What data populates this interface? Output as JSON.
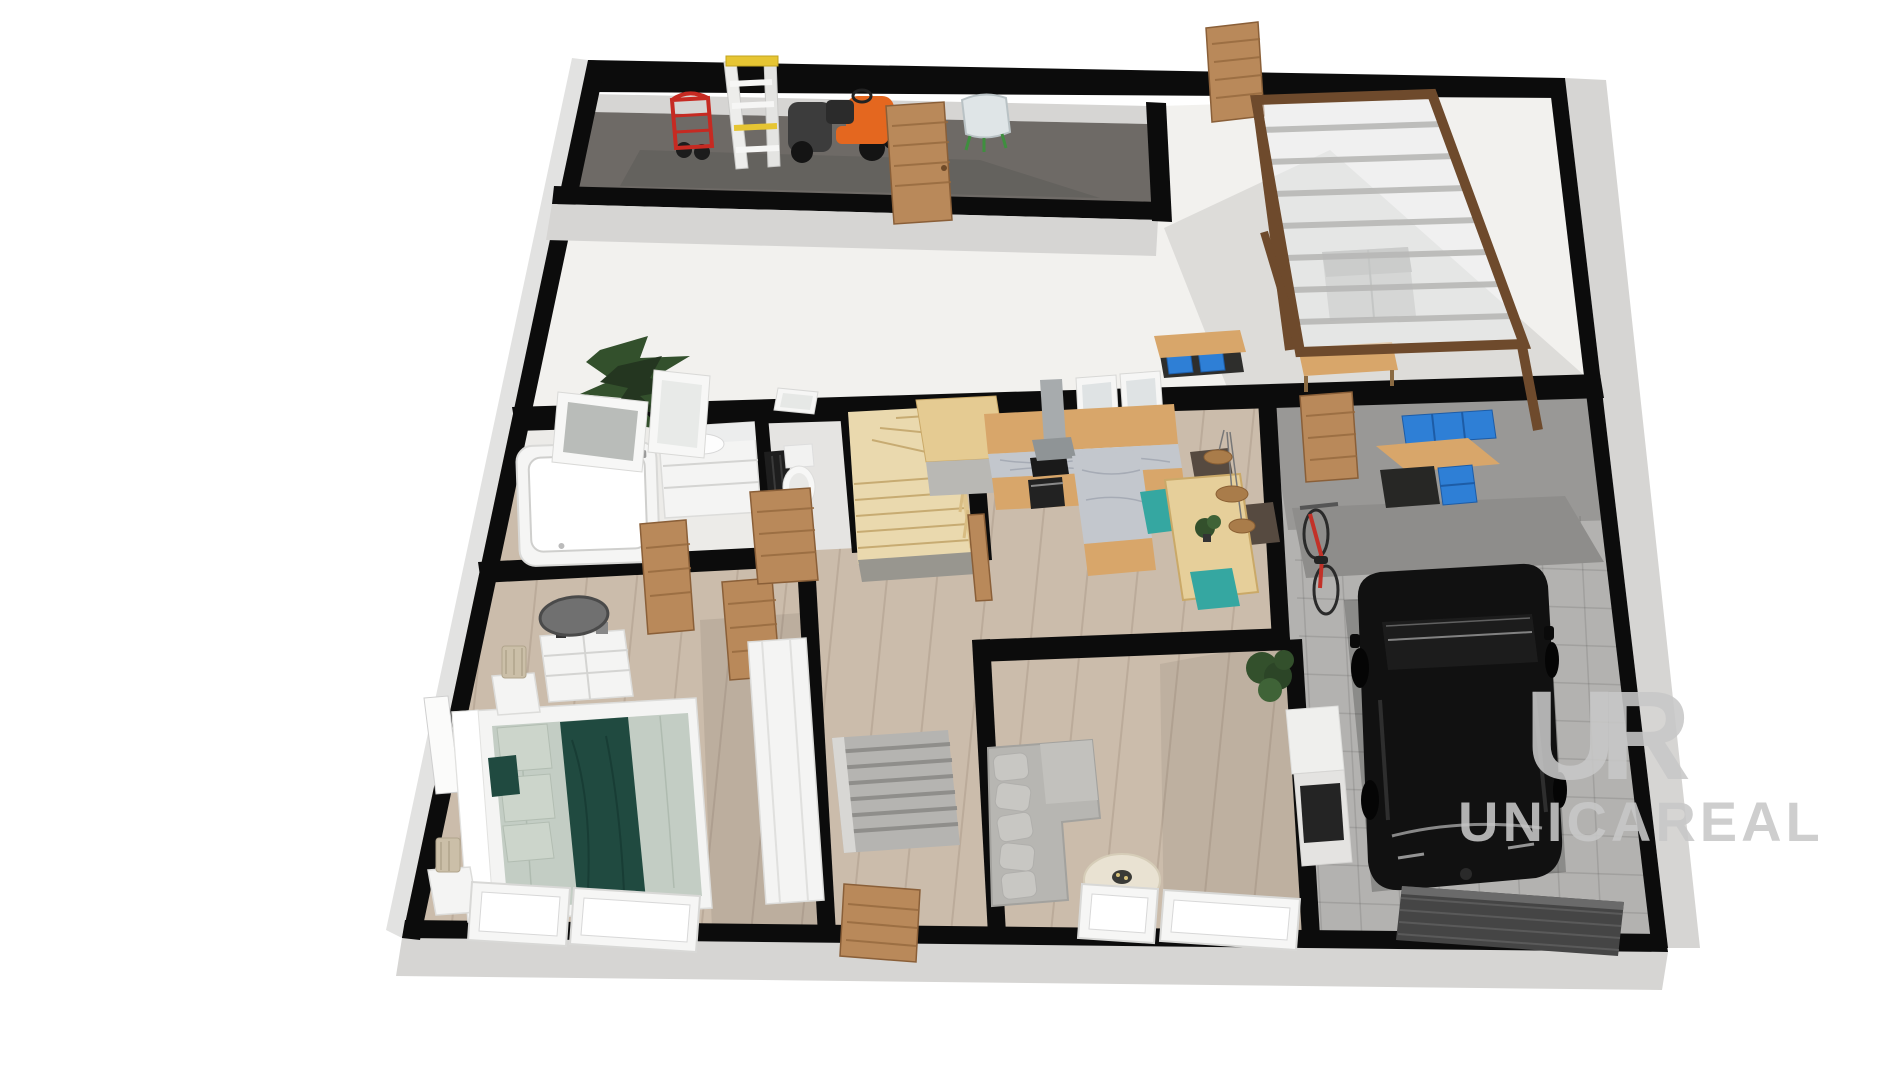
{
  "watermark": {
    "monogram": "UR",
    "brand": "UNICAREAL"
  },
  "colors": {
    "wall": "#0c0c0c",
    "wallface": "#d6d5d3",
    "terrace": "#f2f1ee",
    "storagefloor": "#6e6a66",
    "woodfloor": "#cbbcab",
    "tile": "#b3b2b0",
    "tiledark": "#999896",
    "doorwood": "#b9895a",
    "cabwood": "#d8a66a",
    "stairwood": "#ead9ae",
    "marble": "#c3c7cd",
    "teal": "#35a7a1",
    "bedteal": "#204a40",
    "sofagray": "#b7b6b2",
    "carblack": "#111111",
    "bikered": "#c23128",
    "binblue": "#2e7fd6",
    "mowerorange": "#e4671f",
    "truckred": "#c62a22",
    "ladderyellow": "#e6c533",
    "plantgreen": "#33502c",
    "lampbeige": "#cbbfa8",
    "pergolawood": "#6e4a2c",
    "watermark": "#c8c8c8"
  },
  "scene": {
    "type": "3d-floorplan-render",
    "view": "isometric-top",
    "rooms": [
      {
        "id": "storage-room",
        "items": [
          "hand-truck",
          "step-ladder",
          "riding-mower",
          "storage-door",
          "shell-chair"
        ]
      },
      {
        "id": "terrace",
        "items": [
          "fir-tree",
          "exterior-door",
          "pergola-glass-roof",
          "outdoor-sofa",
          "garden-bench",
          "workbench-with-blue-bins"
        ]
      },
      {
        "id": "bathroom",
        "items": [
          "bathtub",
          "vanity-sink",
          "wall-mirror",
          "radiator",
          "window"
        ]
      },
      {
        "id": "wc",
        "items": [
          "toilet",
          "door",
          "window"
        ]
      },
      {
        "id": "stair-hall",
        "items": [
          "winder-staircase",
          "railing",
          "landing-box"
        ]
      },
      {
        "id": "kitchen",
        "items": [
          "counter",
          "marble-top",
          "cooktop",
          "oven",
          "range-hood",
          "island",
          "windows"
        ]
      },
      {
        "id": "dining-area",
        "items": [
          "dining-table",
          "teal-chairs",
          "dark-chairs",
          "pendant-lights",
          "plant"
        ]
      },
      {
        "id": "entry-hall",
        "items": [
          "front-door",
          "workbench-with-blue-bins"
        ]
      },
      {
        "id": "garage",
        "items": [
          "black-suv",
          "red-bicycle",
          "garage-door",
          "tiled-floor"
        ]
      },
      {
        "id": "bedroom",
        "items": [
          "double-bed",
          "teal-bedding",
          "nightstands",
          "table-lamps",
          "dresser",
          "round-mirror",
          "wardrobe",
          "windows"
        ]
      },
      {
        "id": "living-room",
        "items": [
          "sectional-sofa",
          "coffee-table",
          "media-unit",
          "plant",
          "windows"
        ]
      },
      {
        "id": "center-room",
        "items": [
          "slatted-unit",
          "interior-door"
        ]
      }
    ]
  }
}
